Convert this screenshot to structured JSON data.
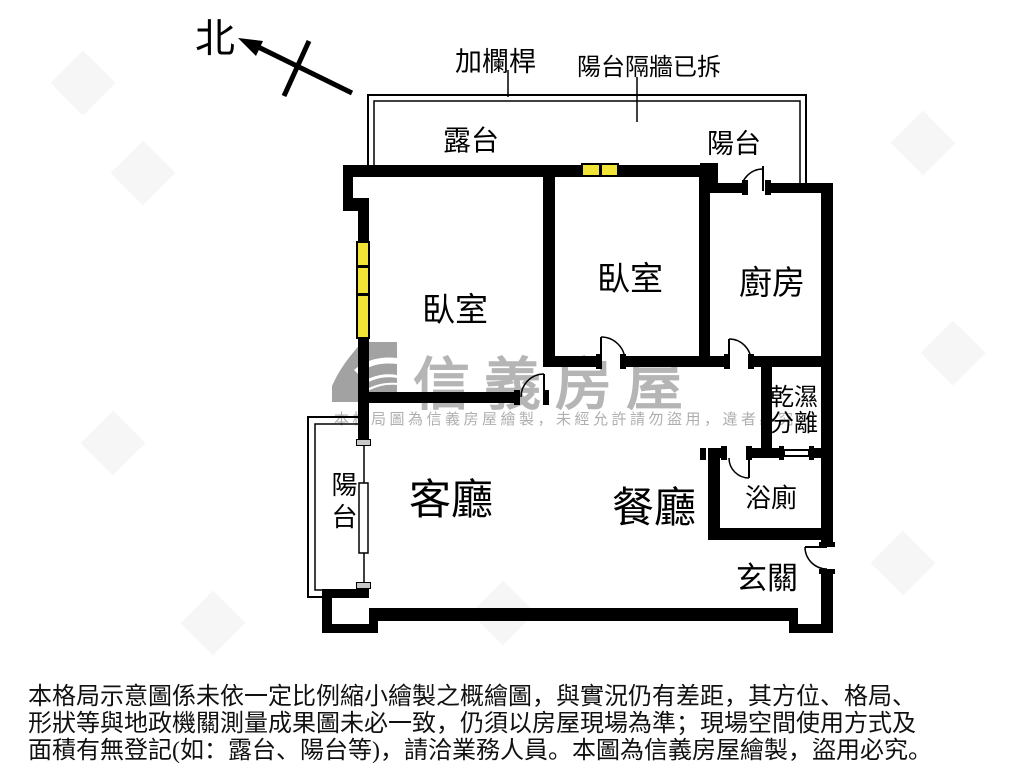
{
  "compass": {
    "north_label": "北"
  },
  "annotations": {
    "add_railing": "加欄桿",
    "balcony_partition_removed": "陽台隔牆已拆"
  },
  "rooms": {
    "terrace": "露台",
    "balcony_top": "陽台",
    "bedroom_left": "臥室",
    "bedroom_middle": "臥室",
    "kitchen": "廚房",
    "dry_wet_line1": "乾濕",
    "dry_wet_line2": "分離",
    "living_room": "客廳",
    "dining_room": "餐廳",
    "bathroom": "浴廁",
    "entry": "玄關",
    "balcony_left": "陽台"
  },
  "watermark": {
    "brand": "信義房屋",
    "notice": "本格局圖為信義房屋繪製，未經允許請勿盜用，違者必究"
  },
  "disclaimer": {
    "line1": "本格局示意圖係未依一定比例縮小繪製之概繪圖，與實況仍有差距，其方位、格局、",
    "line2": "形狀等與地政機關測量成果圖未必一致，仍須以房屋現場為準；現場空間使用方式及",
    "line3": "面積有無登記(如：露台、陽台等)，請洽業務人員。本圖為信義房屋繪製，盜用必究。"
  },
  "colors": {
    "wall": "#000000",
    "window_fill": "#f2e437",
    "watermark_gray": "#b5b5b5"
  }
}
